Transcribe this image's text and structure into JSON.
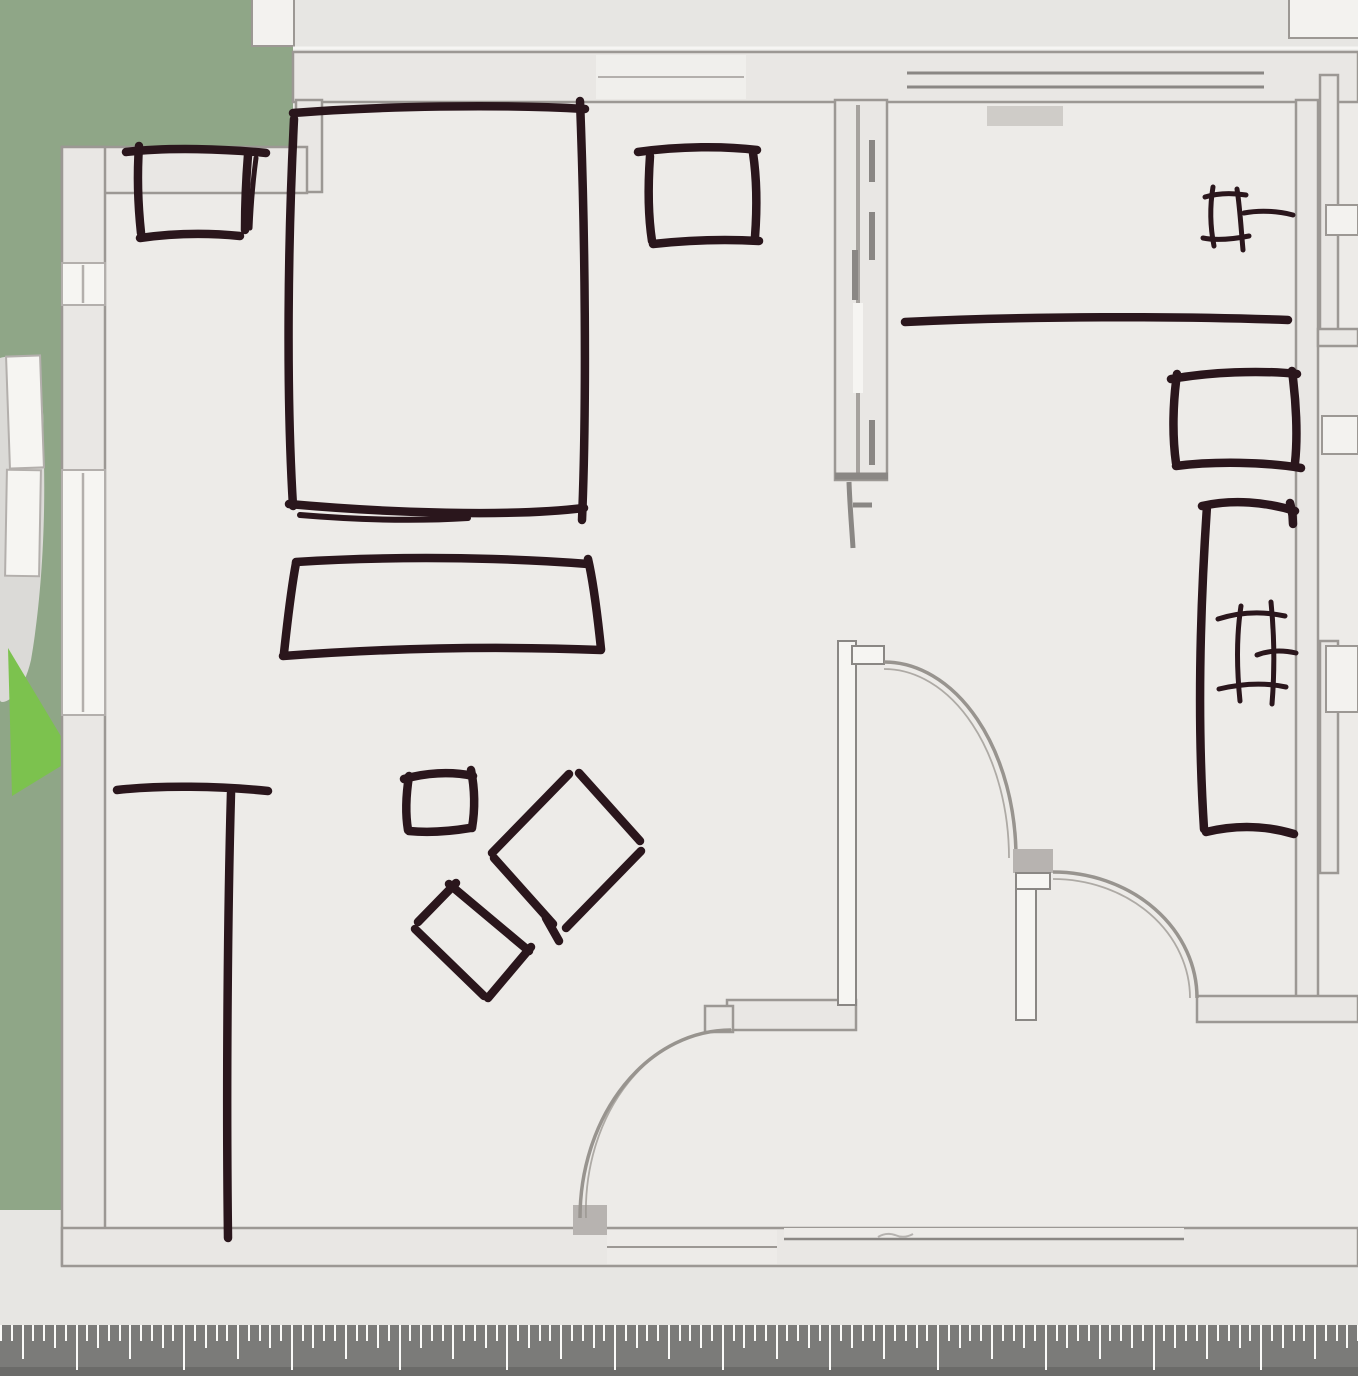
{
  "app": {
    "name": "floor-plan-canvas",
    "description": "Floor plan view with hand-drawn furniture sketch annotations and a measurement ruler"
  },
  "colors": {
    "outside": "#e7e6e3",
    "floor": "#edebe8",
    "yard_green": "#8fa687",
    "plant_green": "#7cc24e",
    "blob": "#dbdad7",
    "wall_fill": "#e9e7e4",
    "wall_edge": "#9c9894",
    "wall_dark": "#8a8784",
    "jamb": "#b7b3b0",
    "door_arc": "#98948f",
    "window_fill": "#f6f5f2",
    "window_line": "#b3afac",
    "fixture_fill": "#f3f2ef",
    "sill": "#cfccc8",
    "smudge": "#b5b2af",
    "ink": "#2a161c",
    "ruler_bg": "#7b7b79",
    "ruler_strip": "#6b6b69",
    "ruler_tick": "#fbfbf9"
  },
  "ruler": {
    "first_major_x": 75.5,
    "minor_spacing": 10.77,
    "minors_per_major": 10,
    "medium_index": 5,
    "sub_indices": [
      2,
      8
    ],
    "major_len": 45,
    "medium_len": 34,
    "sub_len": 23,
    "minor_len": 16,
    "height": 51,
    "strip_height": 9
  },
  "sketch_objects": [
    {
      "id": "bed-sketch",
      "label": "bed"
    },
    {
      "id": "nightstand-left-sketch",
      "label": "nightstand left"
    },
    {
      "id": "nightstand-right-sketch",
      "label": "nightstand right"
    },
    {
      "id": "bench-sketch",
      "label": "bench at foot of bed"
    },
    {
      "id": "closet-line-sketch",
      "label": "closet divider line"
    },
    {
      "id": "side-table-sketch",
      "label": "small square table"
    },
    {
      "id": "diamond-table-sketch",
      "label": "rotated square table"
    },
    {
      "id": "ottoman-sketch",
      "label": "rotated rectangle seat"
    },
    {
      "id": "counter-line-sketch",
      "label": "counter line"
    },
    {
      "id": "valve-top-sketch",
      "label": "fixture hash symbol"
    },
    {
      "id": "cabinet-sketch",
      "label": "cabinet rectangle"
    },
    {
      "id": "tall-counter-sketch",
      "label": "tall counter outline"
    },
    {
      "id": "valve-mid-sketch",
      "label": "fixture hash symbol"
    }
  ]
}
